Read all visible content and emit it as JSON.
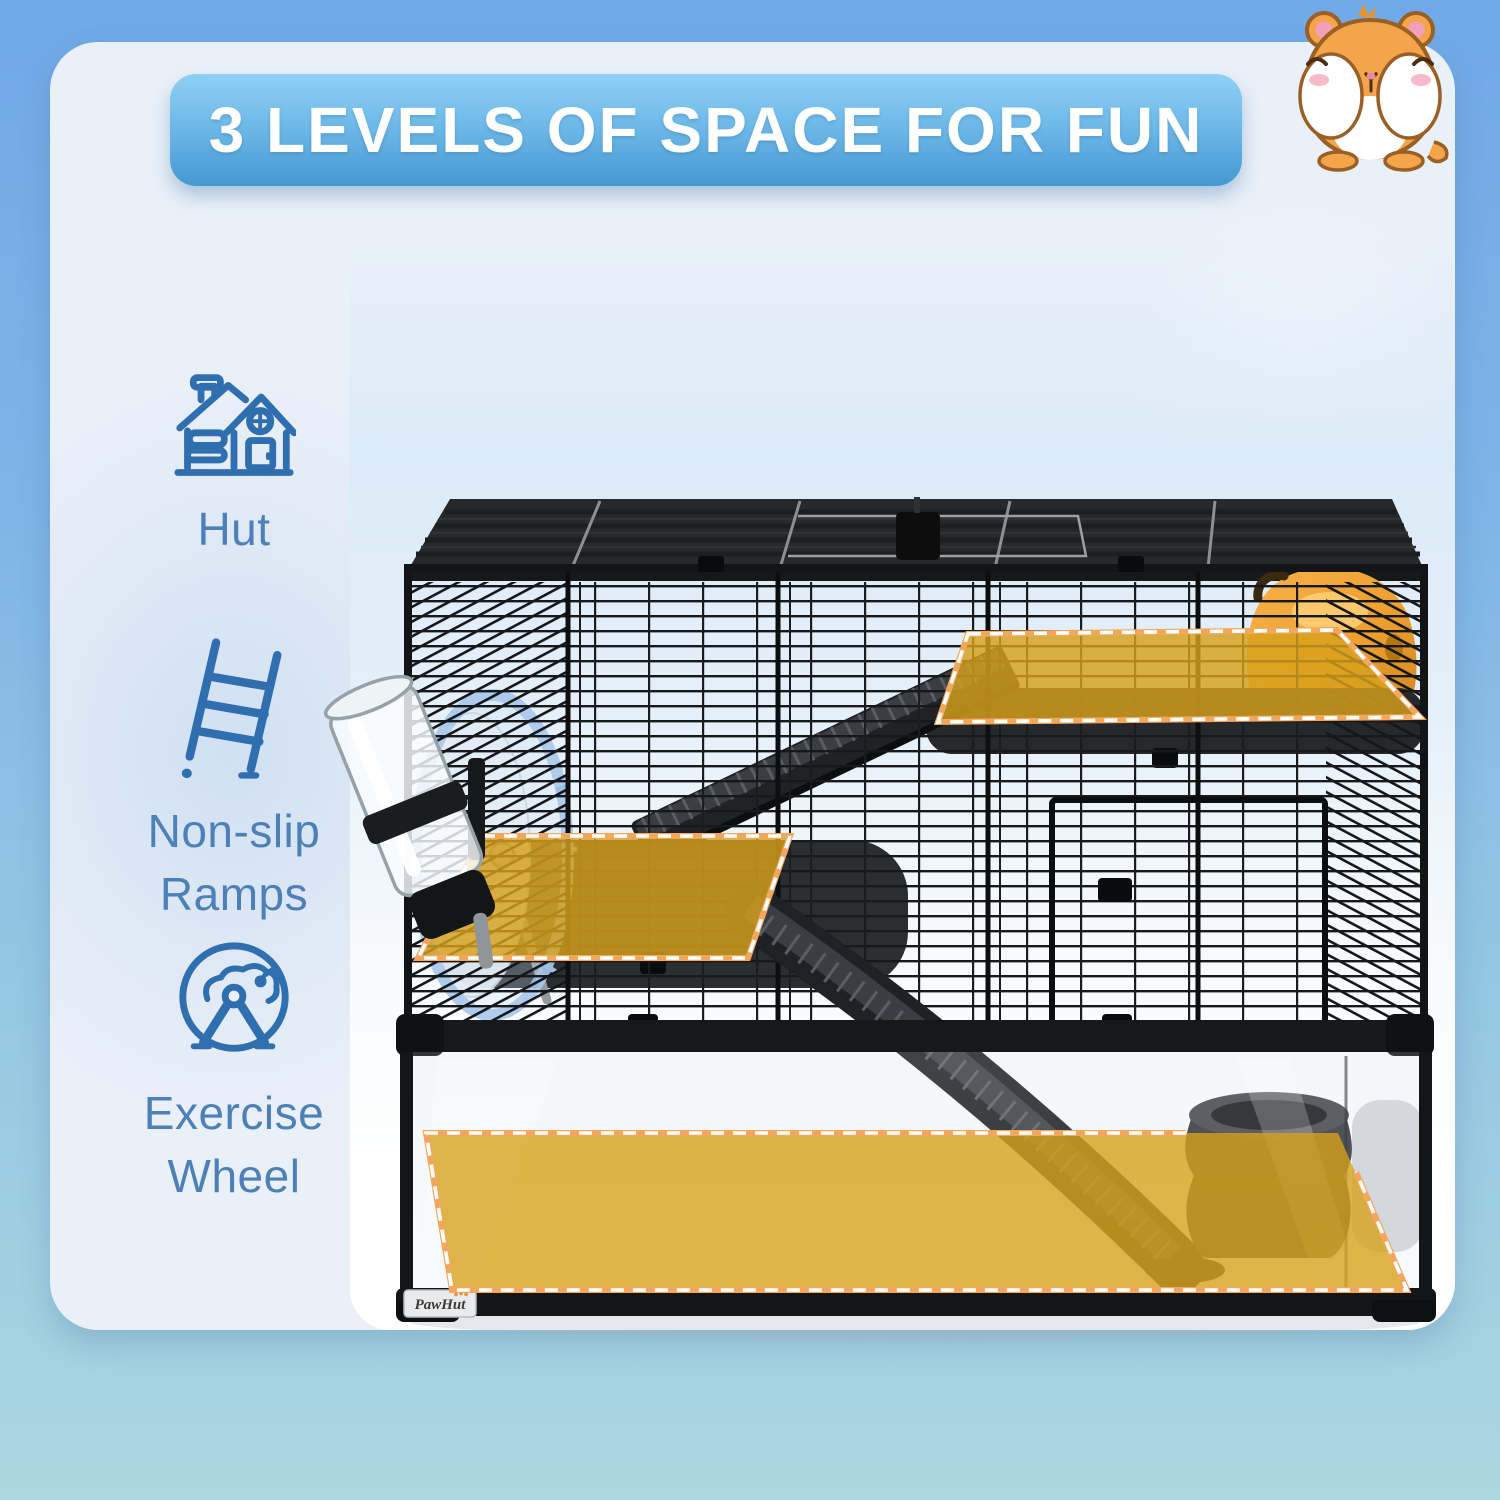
{
  "banner": {
    "title": "3 LEVELS OF SPACE FOR FUN"
  },
  "mascot": {
    "name": "hamster-illustration"
  },
  "sidebar": {
    "items": [
      {
        "icon": "hut-icon",
        "label": "Hut"
      },
      {
        "icon": "ramp-icon",
        "label": "Non-slip Ramps"
      },
      {
        "icon": "exercise-wheel-icon",
        "label": "Exercise Wheel"
      }
    ]
  },
  "product": {
    "brand": "PawHut",
    "levels_highlighted": 3,
    "highlight_color": "#D7A11C"
  },
  "colors": {
    "background_top": "#6FA9E7",
    "background_bottom": "#ABD7E0",
    "card": "#EAF0F8",
    "banner_top": "#8FD0F4",
    "banner_bottom": "#4698D3",
    "icon_blue": "#2F6FB0",
    "label_blue": "#4E80B8",
    "cage_black": "#17181A",
    "hut_orange": "#EFA637"
  }
}
